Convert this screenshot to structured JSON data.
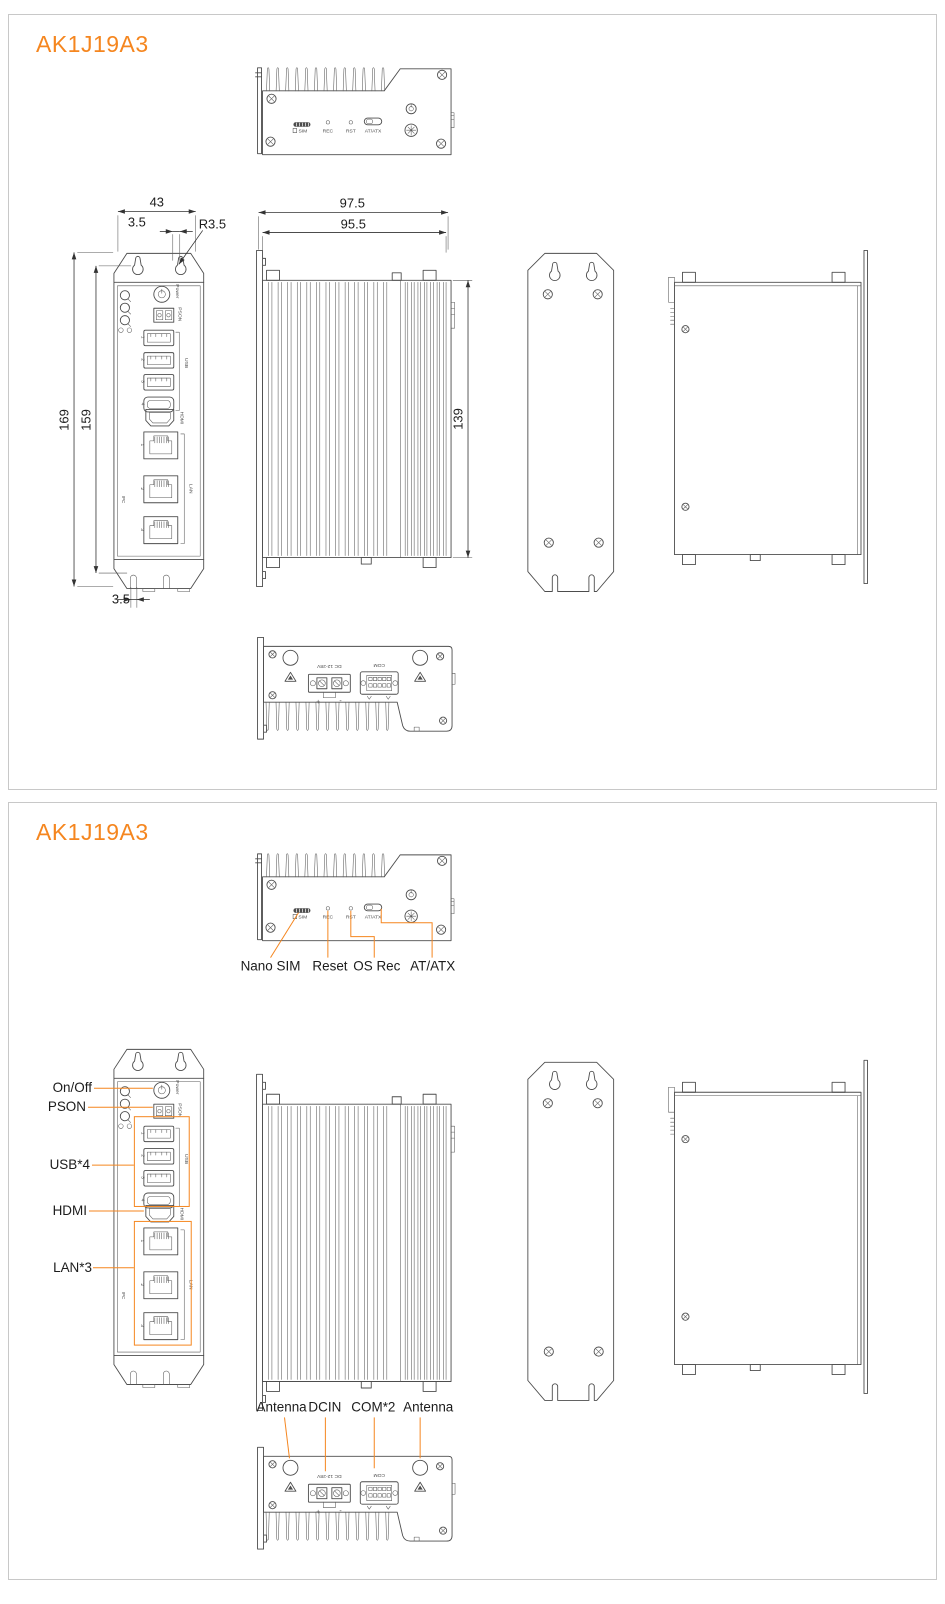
{
  "colors": {
    "accent": "#f5861f",
    "drawing_line": "#4d4d4d",
    "panel_border": "#c8c8c8",
    "dimension_text": "#1c1c1c",
    "background": "#ffffff"
  },
  "panel1": {
    "title": "AK1J19A3",
    "dims": {
      "top_width": "43",
      "top_offset": "3.5",
      "corner_radius": "R3.5",
      "height_outer": "169",
      "height_inner": "159",
      "bottom_offset": "3.5",
      "hs_outer": "97.5",
      "hs_inner": "95.5",
      "hs_height": "139"
    }
  },
  "panel2": {
    "title": "AK1J19A3",
    "top_callouts": {
      "sim": "Nano SIM",
      "reset": "Reset",
      "osrec": "OS Rec",
      "atx": "AT/ATX"
    },
    "front_callouts": {
      "power": "On/Off",
      "pson": "PSON",
      "usb": "USB*4",
      "hdmi": "HDMI",
      "lan": "LAN*3"
    },
    "bottom_callouts": {
      "ant_left": "Antenna",
      "dcin": "DCIN",
      "com": "COM*2",
      "ant_right": "Antenna"
    }
  },
  "marks": {
    "sim": "SIM",
    "rec": "REC",
    "rst": "RST",
    "atx": "AT/ATX",
    "power": "Power",
    "pson": "PSON",
    "usb": "USB",
    "hdmi": "HDMI",
    "lan": "LAN",
    "u1": "1",
    "u2": "2",
    "u3": "3",
    "u4": "4",
    "l1": "1",
    "l2": "2",
    "l3": "3",
    "dc": "DC 12-28V",
    "com": "COM",
    "plus": "+",
    "minus": "-",
    "brand": "IPC"
  }
}
